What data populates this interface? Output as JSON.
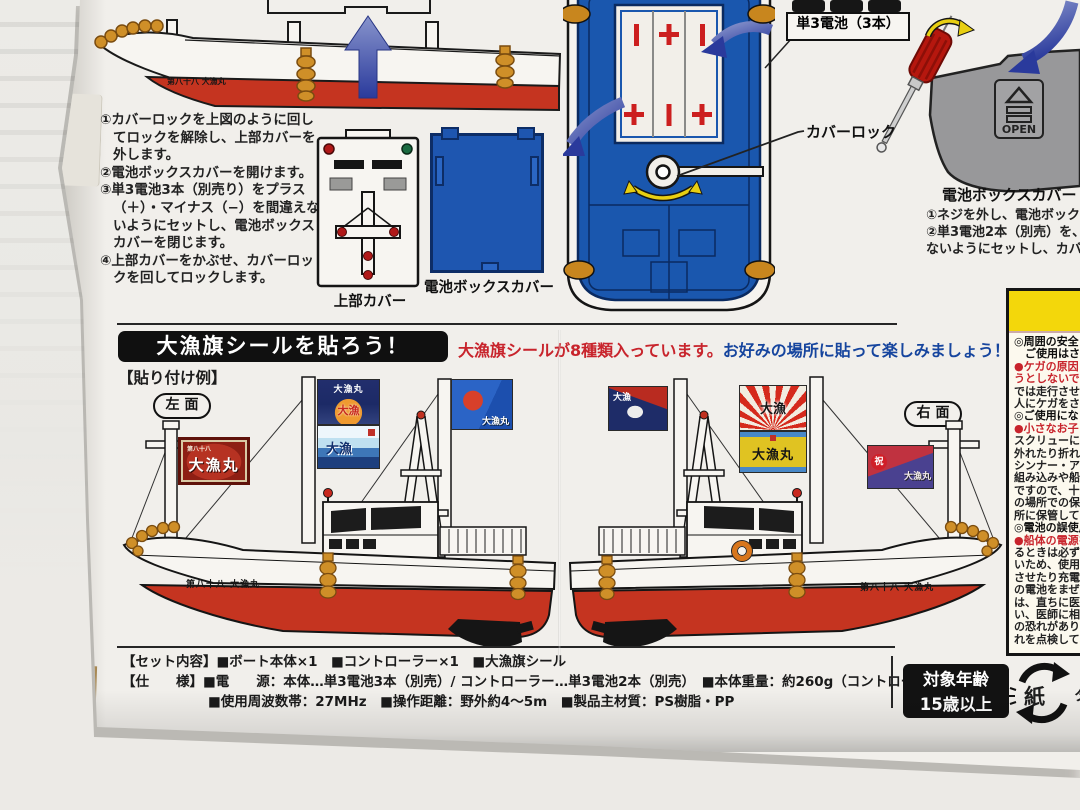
{
  "box": {
    "hull_name": "第八十八 大漁丸",
    "battery_section": {
      "boat_steps": [
        "①カバーロックを上図のように回してロックを解除し、上部カバーを外します。",
        "②電池ボックスカバーを開けます。",
        "③単3電池3本（別売り）をプラス（＋）・マイナス（−）を間違えないようにセットし、電池ボックスカバーを閉じます。",
        "④上部カバーをかぶせ、カバーロックを回してロックします。"
      ],
      "top_cover_label": "上部カバー",
      "battery_cover_label": "電池ボックスカバー",
      "cover_lock_label": "カバーロック",
      "batteries_label": "単3電池（3本）",
      "open_label": "OPEN",
      "controller_cover_label": "電池ボックスカバー",
      "controller_steps": [
        "①ネジを外し、電池ボックス",
        "②単3電池2本（別売）を、プ",
        "ないようにセットし、カバー"
      ]
    },
    "sticker_section": {
      "heading": "大漁旗シールを貼ろう！",
      "note_red": "大漁旗シールが8種類入っています。",
      "note_blue": "お好みの場所に貼って楽しみましょう！",
      "example_label": "【貼り付け例】",
      "side_left": "左面",
      "side_right": "右面",
      "flags": [
        {
          "top": "第八十八",
          "main": "大漁丸"
        },
        {
          "top": "大漁丸",
          "main": "大漁"
        },
        {
          "main": "大漁"
        },
        {
          "main": "大漁丸"
        },
        {
          "main": "大漁"
        },
        {
          "main": "大漁"
        },
        {
          "main": "大漁丸"
        },
        {
          "stamp": "祝",
          "main": "大漁丸"
        }
      ]
    },
    "warning_panel": {
      "lines": [
        {
          "text": "◎周囲の安全",
          "cls": "wb"
        },
        {
          "text": "　ご使用はさ",
          "cls": "wb"
        },
        {
          "text": "●ケガの原因",
          "cls": "wr"
        },
        {
          "text": "うとしないで",
          "cls": "wr"
        },
        {
          "text": "では走行させ",
          "cls": "wk"
        },
        {
          "text": "人にケガをさ",
          "cls": "wk"
        },
        {
          "text": "◎ご使用にな",
          "cls": "wb"
        },
        {
          "text": "●小さなお子",
          "cls": "wr"
        },
        {
          "text": "スクリューに",
          "cls": "wk"
        },
        {
          "text": "外れたり折れ",
          "cls": "wk"
        },
        {
          "text": "シンナー・アル",
          "cls": "wk"
        },
        {
          "text": "組み込みや船",
          "cls": "wk"
        },
        {
          "text": "ですので、十分",
          "cls": "wk"
        },
        {
          "text": "の場所での保",
          "cls": "wk"
        },
        {
          "text": "所に保管してく",
          "cls": "wk"
        },
        {
          "text": "◎電池の誤使用",
          "cls": "wb"
        },
        {
          "text": "●船体の電源を",
          "cls": "wr"
        },
        {
          "text": "るときは必ず電",
          "cls": "wk"
        },
        {
          "text": "いため、使用し",
          "cls": "wk"
        },
        {
          "text": "させたり充電、",
          "cls": "wk"
        },
        {
          "text": "の電池をまぜて",
          "cls": "wk"
        },
        {
          "text": "は、直ちに医師",
          "cls": "wk"
        },
        {
          "text": "い、医師に相談し",
          "cls": "wk"
        },
        {
          "text": "の恐れがあります",
          "cls": "wk"
        },
        {
          "text": "れを点検してくだ",
          "cls": "wk"
        }
      ]
    },
    "specs": {
      "line1": "【セット内容】■ボート本体×1　■コントローラー×1　■大漁旗シール",
      "line2": "【仕　　様】■電　　源：本体…単3電池3本（別売）/ コントローラー…単3電池2本（別売）　■本体重量：約260g（コントローラー含む）",
      "line3": "■使用周波数帯：27MHz　■操作距離：野外約4〜5m　■製品主材質：PS樹脂・PP"
    },
    "age_badge": {
      "line1": "対象年齢",
      "line2": "15歳以上"
    },
    "recycle_mark": {
      "kanji": "紙",
      "partial": "タ"
    },
    "colors": {
      "hull_red": "#c53420",
      "deck_blue": "#1a57ae",
      "warning_yellow": "#f3d70b",
      "text_red": "#c8242c",
      "text_blue": "#16459e",
      "gold": "#cf8f28"
    }
  }
}
